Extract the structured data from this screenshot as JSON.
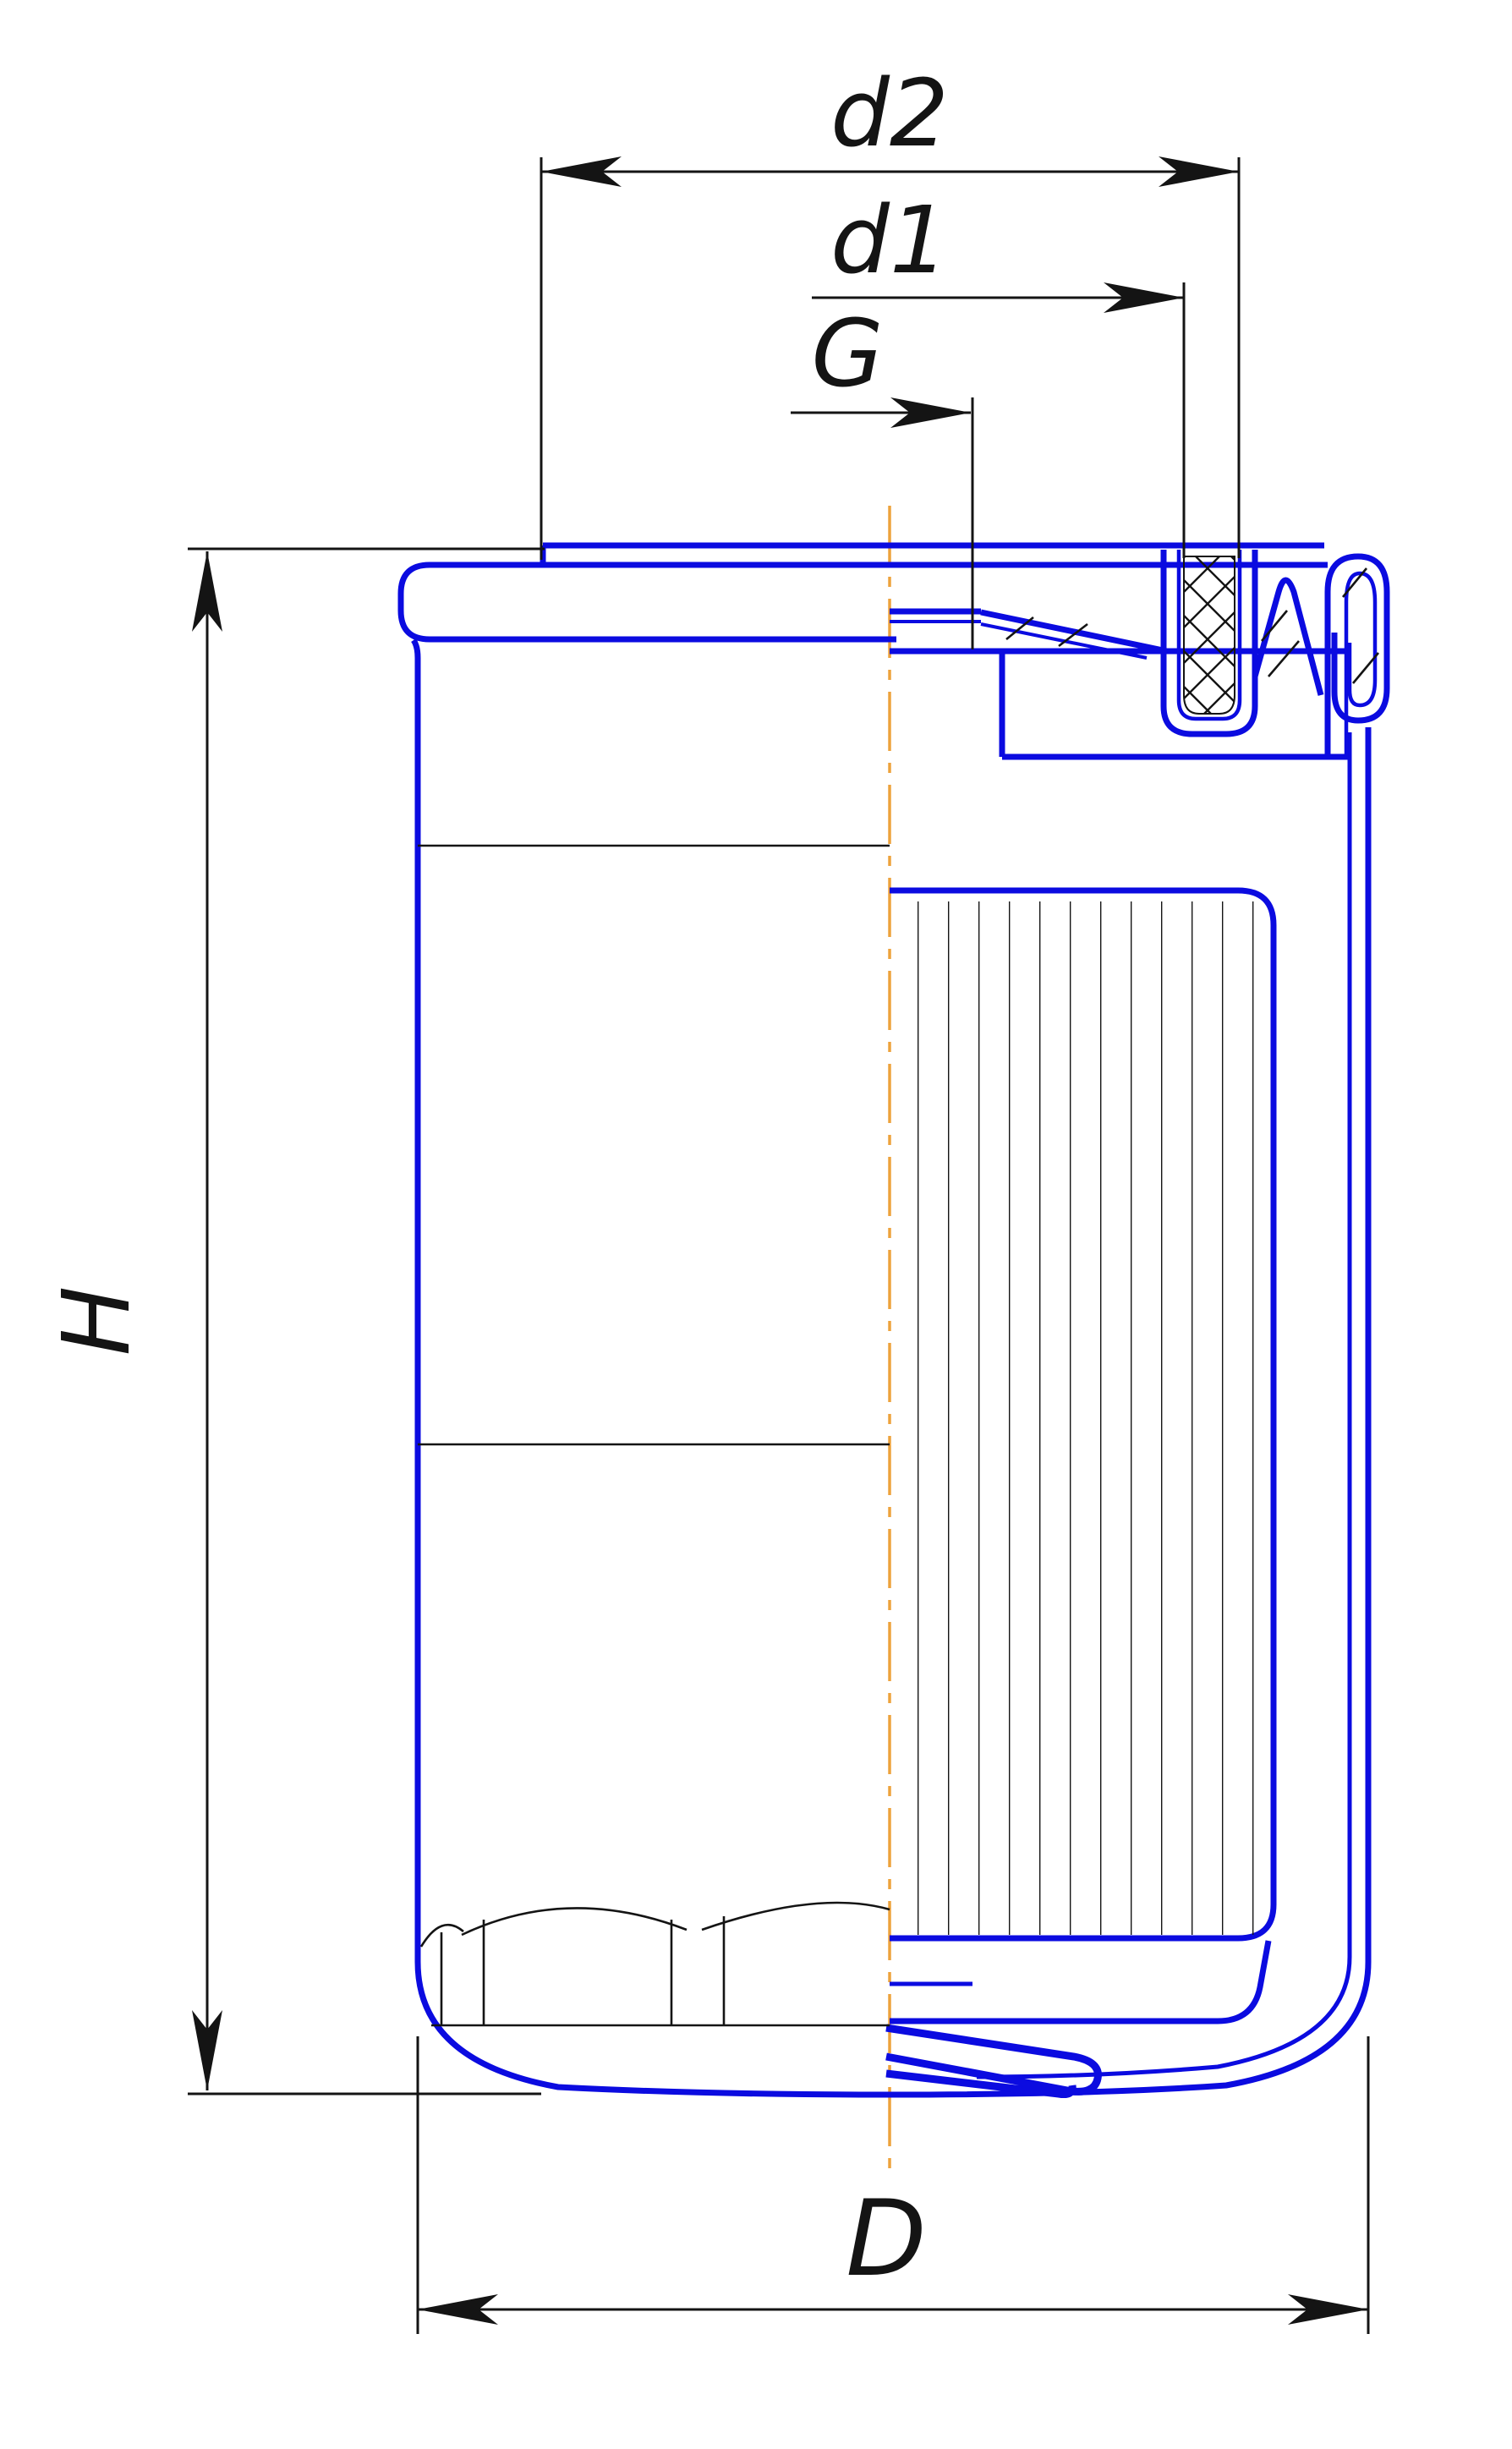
{
  "page": {
    "background": "#ffffff"
  },
  "drawing": {
    "name": "Spin-on oil filter sectional drawing (half section)",
    "dimension_labels": {
      "d2": "d2",
      "d1": "d1",
      "thread": "G",
      "height": "H",
      "outer_diameter": "D"
    },
    "colors": {
      "part_outline": "#0b0be0",
      "dimension_lines": "#141414",
      "center_line": "#eda23c",
      "hatch": "#141414",
      "background": "#ffffff"
    }
  }
}
